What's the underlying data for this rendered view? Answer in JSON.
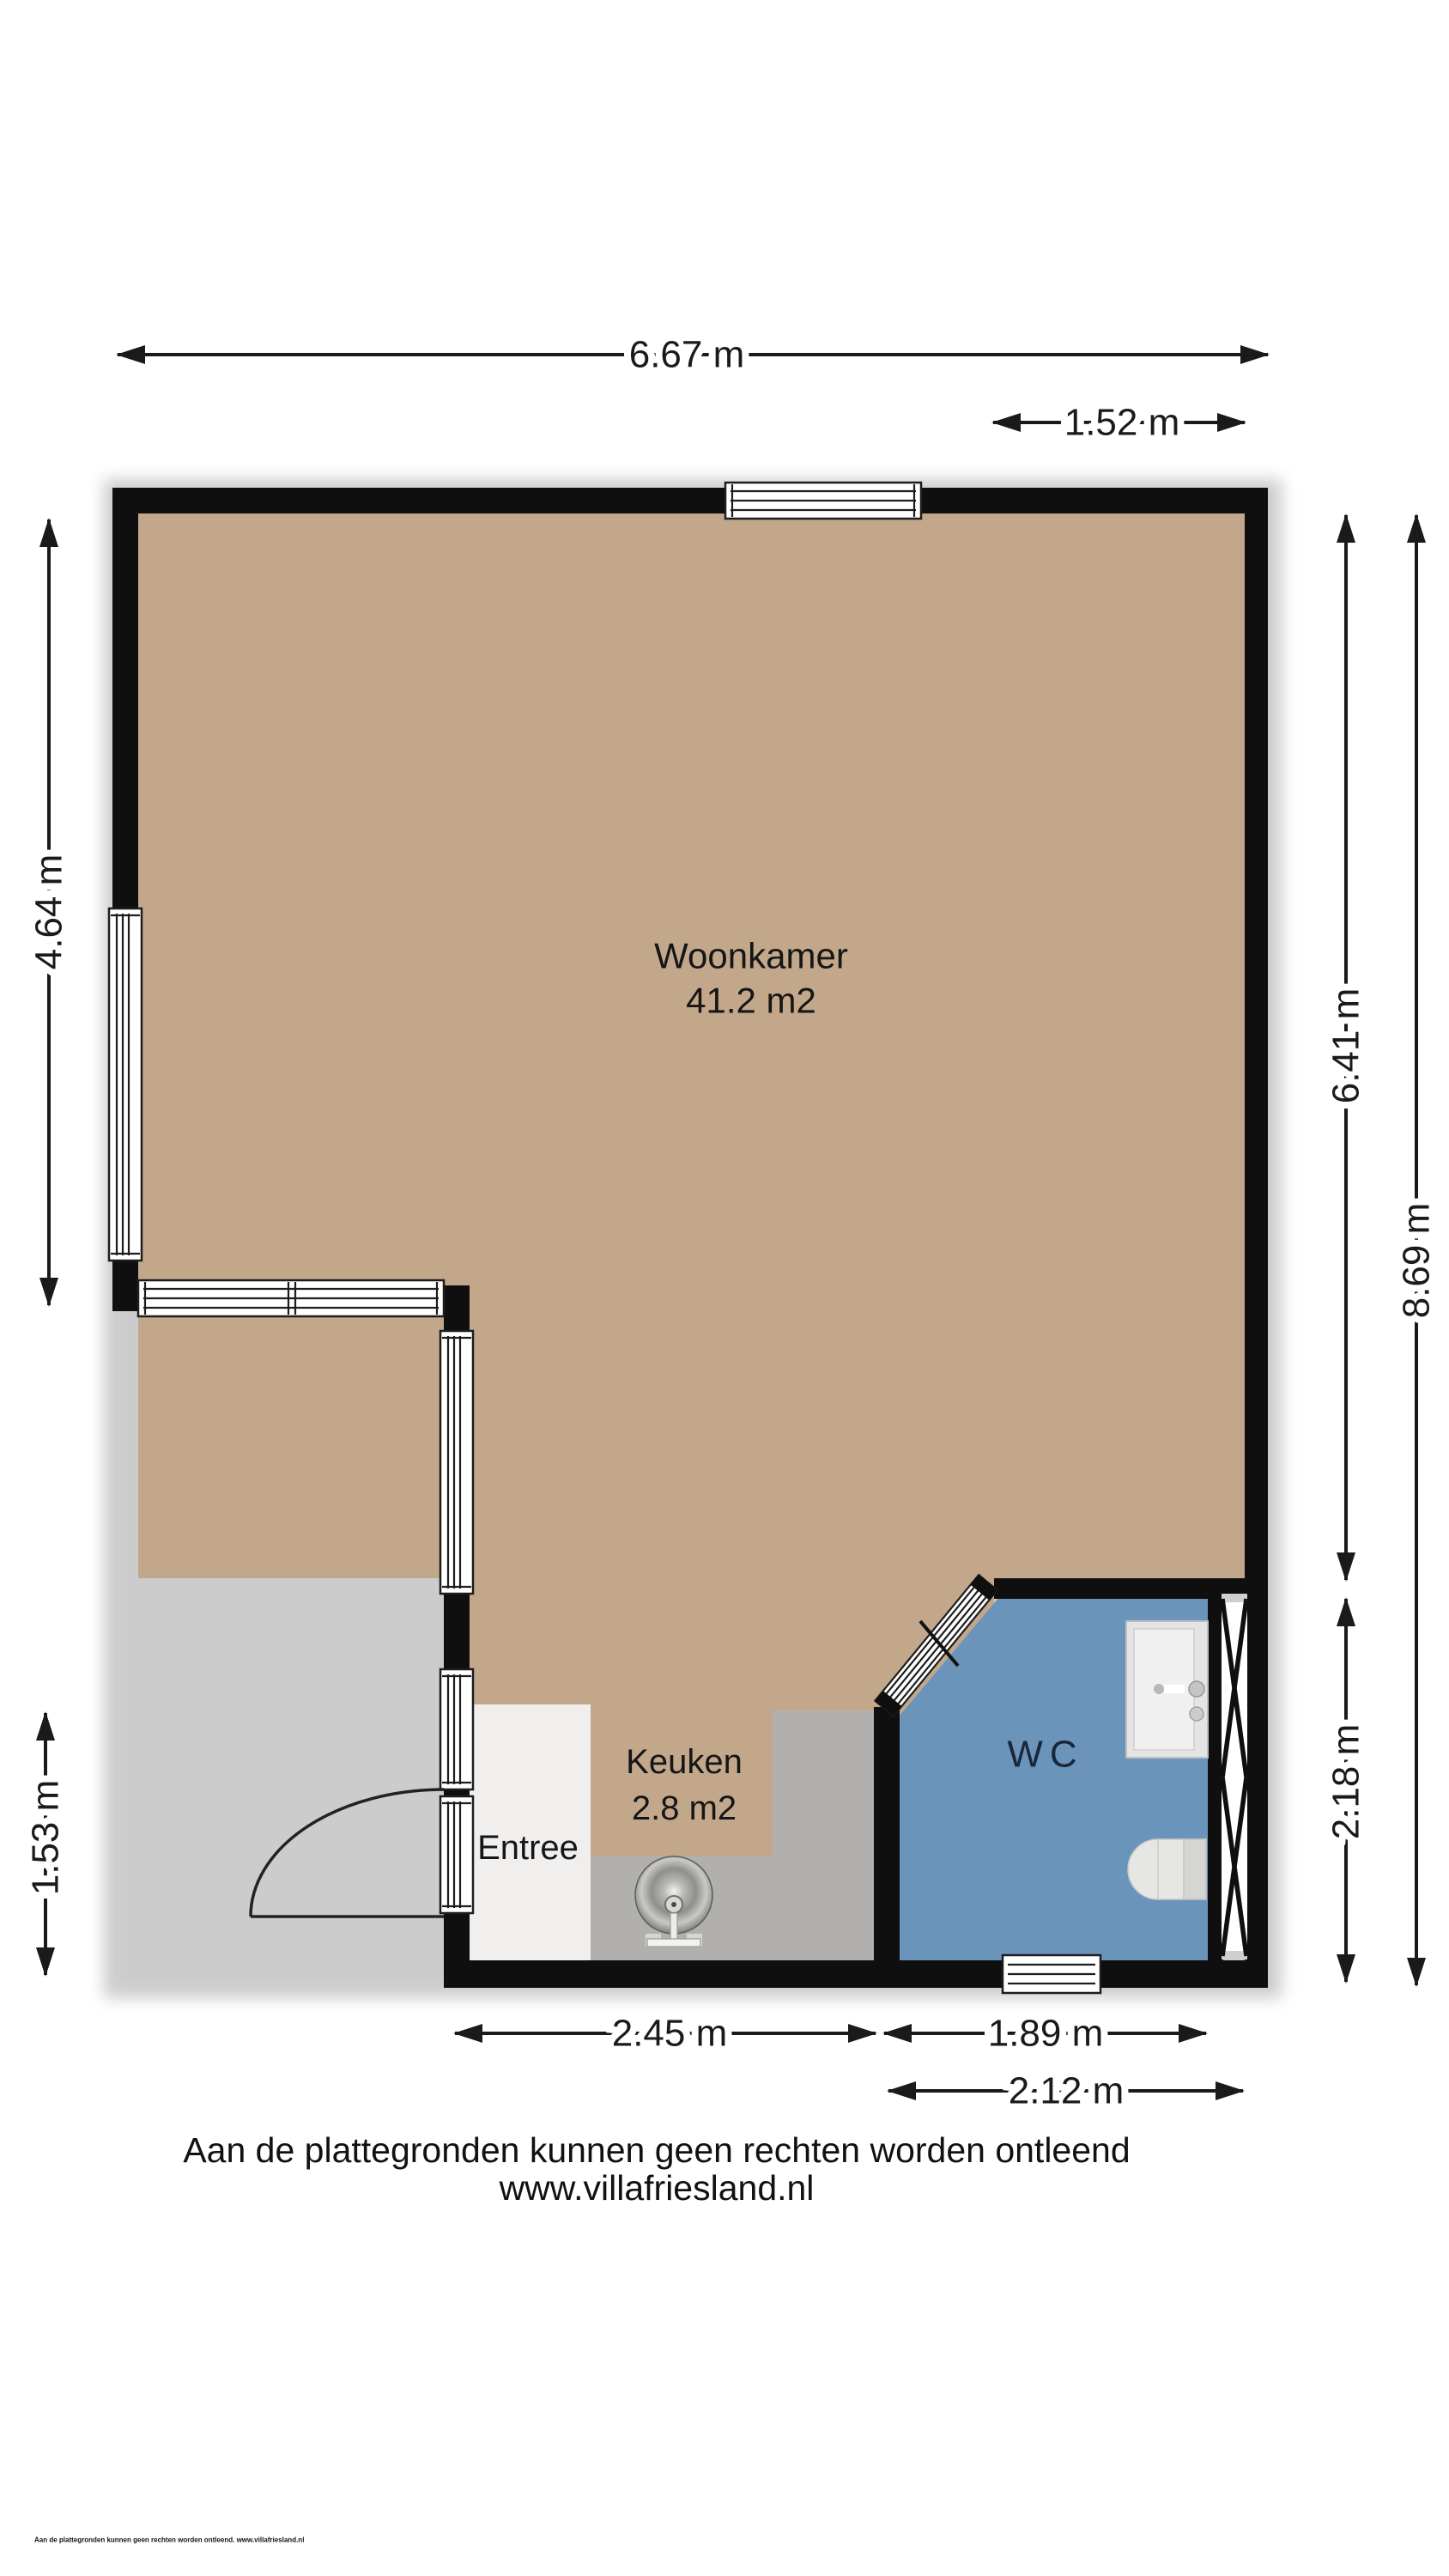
{
  "colors": {
    "wall": "#0f0f0f",
    "line": "#1a1a1a",
    "label": "#161616",
    "wc-label": "#1a2738",
    "floor-tan": "#c2a78b",
    "floor-gray": "#b1b0ae",
    "floor-blue": "#6b94bb",
    "floor-entree": "#f0efee"
  },
  "rooms": {
    "woonkamer": {
      "name": "Woonkamer",
      "area": "41.2 m2"
    },
    "keuken": {
      "name": "Keuken",
      "area": "2.8 m2"
    },
    "entree": {
      "name": "Entree"
    },
    "wc": {
      "name": "WC"
    }
  },
  "dimensions": {
    "total_width": "6.67 m",
    "top_right_width": "1.52 m",
    "left_upper": "4.64 m",
    "left_lower": "1.53 m",
    "right_upper": "6.41 m",
    "right_total": "8.69 m",
    "right_lower": "2.18 m",
    "bottom_left": "2.45 m",
    "bottom_middle": "1.89 m",
    "bottom_right": "2.12 m"
  },
  "footer": {
    "disclaimer": "Aan de plattegronden kunnen geen rechten worden ontleend",
    "website": "www.villafriesland.nl",
    "fine_print": "Aan de plattegronden kunnen geen rechten worden ontleend. www.villafriesland.nl"
  }
}
